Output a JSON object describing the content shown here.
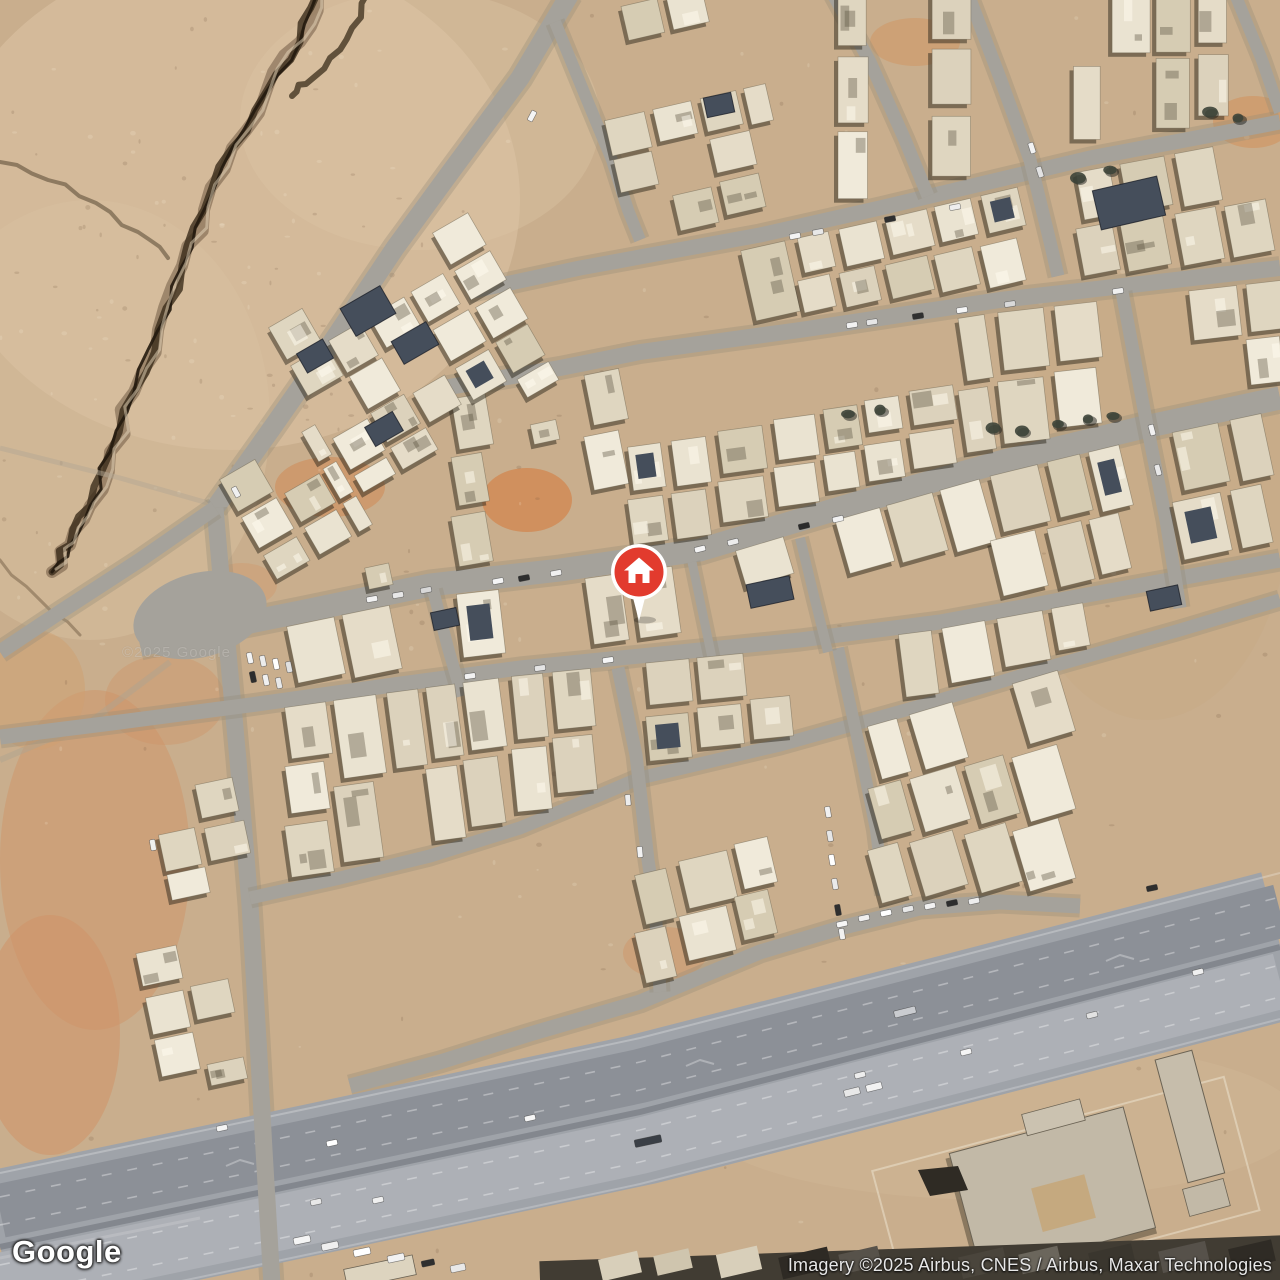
{
  "map_view": {
    "description": "Satellite imagery of a desert residential district with a dry wadi crack, street grid and a highway",
    "marker": {
      "icon": "home-icon",
      "pin_color": "#E23B2E",
      "glyph_color": "#FFFFFF",
      "ring_color": "#FFFFFF"
    },
    "branding": {
      "logo_text": "Google"
    },
    "attribution": {
      "imagery_credit": "Imagery ©2025 Airbus, CNES / Airbus, Maxar Technologies",
      "watermark": "©2025 Google"
    },
    "palette": {
      "sand": "#C9AE8D",
      "sand_light": "#DCC5A6",
      "sand_orange": "#D09467",
      "sand_orange_strong": "#D2854F",
      "road": "#A5A29B",
      "road_soft": "#B8B2A4",
      "highway_base": "#9FA3A9",
      "highway_dark": "#8C9097",
      "highway_light": "#ADB0B6",
      "crack_dark": "#3A2C1A",
      "crack_soft": "#5A4530",
      "building_roofs": [
        "#EAE3D1",
        "#DFD6C0",
        "#E5DCC8",
        "#D6CCB3",
        "#F0EADA",
        "#DCD2BC"
      ],
      "building_shadow": "rgba(45,39,28,0.5)",
      "dark_roof": "#454E5B",
      "tree": "#3D4438"
    }
  }
}
